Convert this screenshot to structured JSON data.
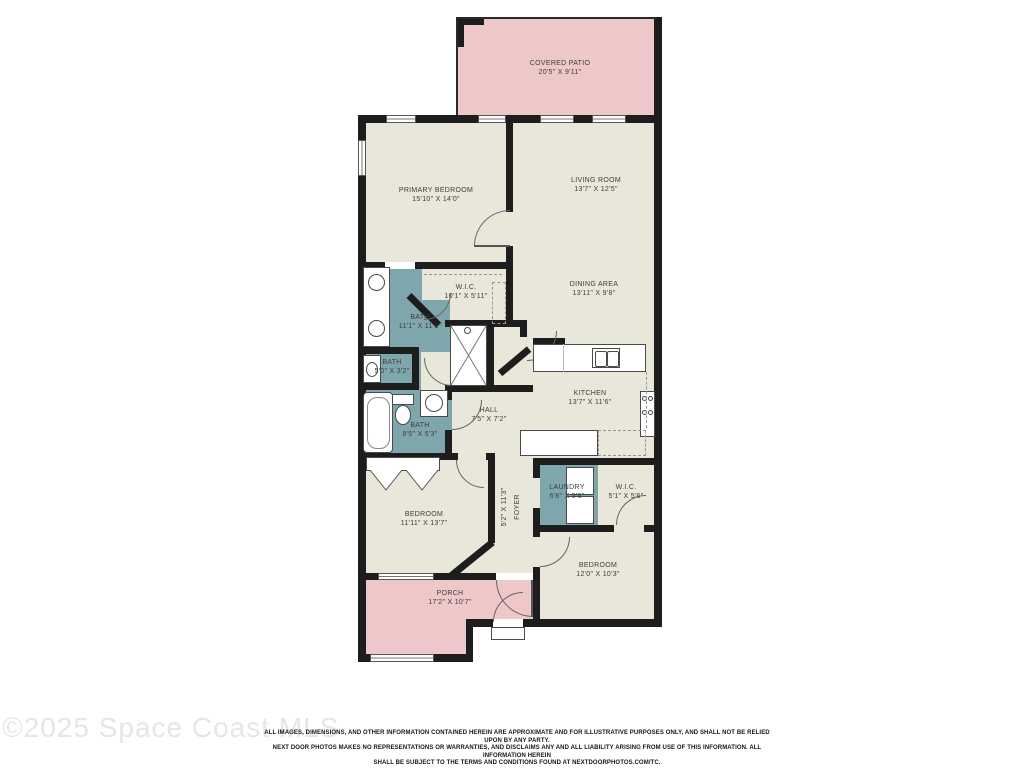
{
  "watermark": "©2025 Space Coast MLS",
  "disclaimer": {
    "line1": "ALL IMAGES, DIMENSIONS, AND OTHER INFORMATION CONTAINED HEREIN ARE APPROXIMATE AND FOR ILLUSTRATIVE PURPOSES ONLY, AND SHALL NOT BE RELIED UPON BY ANY PARTY.",
    "line2": "NEXT DOOR PHOTOS MAKES NO REPRESENTATIONS OR WARRANTIES, AND DISCLAIMS ANY AND ALL LIABILITY ARISING FROM USE OF THIS INFORMATION. ALL INFORMATION HEREIN",
    "line3": "SHALL BE SUBJECT TO THE TERMS AND CONDITIONS FOUND AT NEXTDOORPHOTOS.COM/TC."
  },
  "colors": {
    "floor": "#e9e6da",
    "outdoor": "#eec7c9",
    "wet_room": "#7ea7ad",
    "wall": "#1d1d1d",
    "label_text": "#3d3d3d",
    "watermark_text": "#e8e6e2"
  },
  "rooms": {
    "covered_patio": {
      "name": "COVERED PATIO",
      "dims": "20'5\" X 9'11\""
    },
    "primary_bedroom": {
      "name": "PRIMARY BEDROOM",
      "dims": "15'10\" X 14'0\""
    },
    "living_room": {
      "name": "LIVING ROOM",
      "dims": "13'7\" X 12'5\""
    },
    "wic_primary": {
      "name": "W.I.C.",
      "dims": "10'1\" X 5'11\""
    },
    "bath_primary": {
      "name": "BATH",
      "dims": "11'1\" X 11'1\""
    },
    "dining_area": {
      "name": "DINING AREA",
      "dims": "13'11\" X 9'8\""
    },
    "bath_wc": {
      "name": "BATH",
      "dims": "5'0\" X 3'2\""
    },
    "kitchen": {
      "name": "KITCHEN",
      "dims": "13'7\" X 11'6\""
    },
    "bath_hall": {
      "name": "BATH",
      "dims": "8'5\" X 5'3\""
    },
    "hall": {
      "name": "HALL",
      "dims": "7'5\" X 7'2\""
    },
    "foyer": {
      "name": "FOYER",
      "dims": "5'2\" X 11'3\""
    },
    "laundry": {
      "name": "LAUNDRY",
      "dims": "6'8\" X 5'6\""
    },
    "wic_2": {
      "name": "W.I.C.",
      "dims": "5'1\" X 5'6\""
    },
    "bedroom_2": {
      "name": "BEDROOM",
      "dims": "11'11\" X 13'7\""
    },
    "porch": {
      "name": "PORCH",
      "dims": "17'2\" X 10'7\""
    },
    "bedroom_3": {
      "name": "BEDROOM",
      "dims": "12'0\" X 10'3\""
    }
  }
}
